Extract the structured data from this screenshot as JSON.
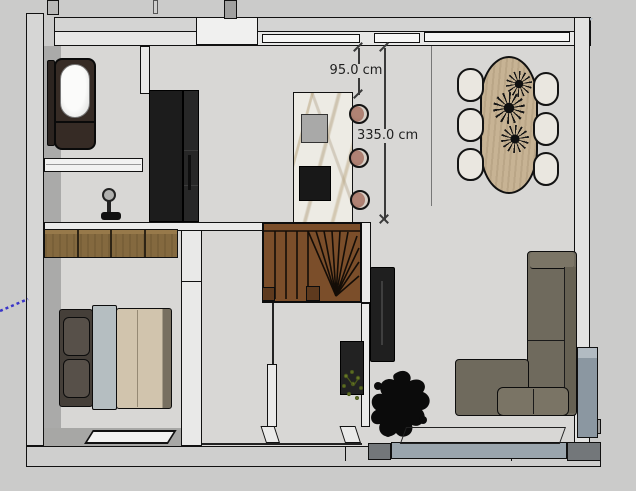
{
  "viewport": {
    "type": "3d-floorplan-top-view",
    "background": "#cbcbca"
  },
  "dims": {
    "a": {
      "label": "95.0 cm"
    },
    "b": {
      "label": "335.0 cm"
    }
  },
  "colors": {
    "canvas": "#cbcbca",
    "floor": "#d8d7d5",
    "wall_top": "#eaeae9",
    "wall_outer": "#d6d6d5",
    "wall_inner_face": "#a9a9a8",
    "stairs_wood": "#7b4e2a",
    "wardrobe_wood": "#84693f",
    "table_wood": "#c7b394",
    "kitchen_unit": "#1c1c1c",
    "island_marble": "#edebe4",
    "stool": "#a5786a",
    "sofa": "#6f6a5d",
    "bed_duvet": "#d1c4ad",
    "bed_sheet": "#b5bec1",
    "bath_surround": "#362b25",
    "accent_blue_gray": "#8b97a1",
    "window_slab": "#9aa5ad",
    "guide_blue": "#3a35c9",
    "dimension_text": "#1f1f1f"
  }
}
